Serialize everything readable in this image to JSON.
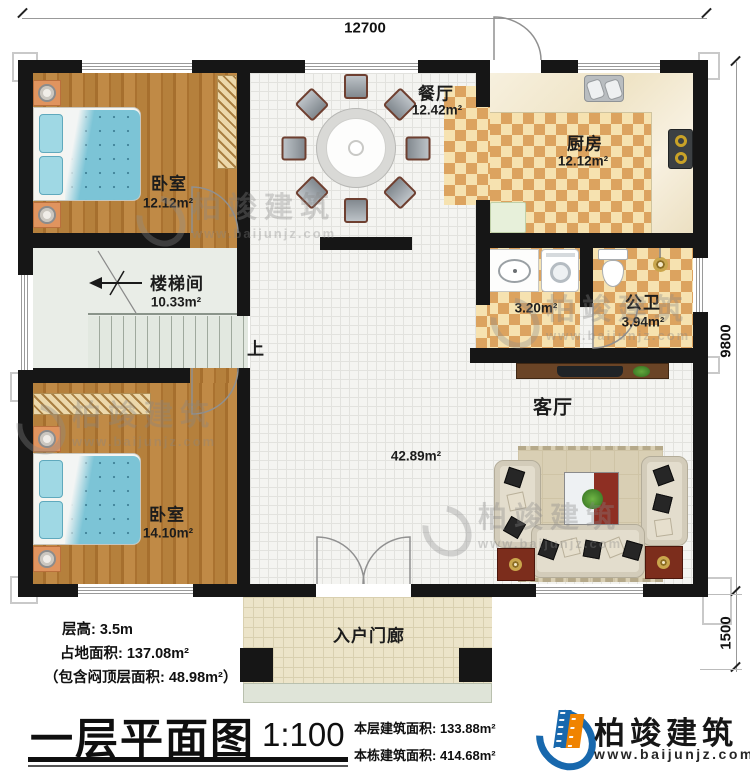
{
  "dimensions": {
    "top": "12700",
    "right_main": "9800",
    "right_porch": "1500"
  },
  "rooms": {
    "bedroom1": {
      "name": "卧室",
      "area": "12.12m²"
    },
    "dining": {
      "name": "餐厅",
      "area": "12.42m²"
    },
    "kitchen": {
      "name": "厨房",
      "area": "12.12m²"
    },
    "stairwell": {
      "name": "楼梯间",
      "area": "10.33m²"
    },
    "wash": {
      "area": "3.20m²"
    },
    "toilet": {
      "name": "公卫",
      "area": "3.94m²"
    },
    "living": {
      "name": "客厅",
      "area": "42.89m²"
    },
    "bedroom2": {
      "name": "卧室",
      "area": "14.10m²"
    },
    "porch": {
      "name": "入户门廊"
    }
  },
  "annotations": {
    "stairs_up": "上"
  },
  "info": {
    "floor_height": "层高: 3.5m",
    "land_area": "占地面积: 137.08m²",
    "attic_note": "（包含闷顶层面积: 48.98m²）"
  },
  "title_block": {
    "title": "一层平面图",
    "scale": "1:100",
    "floor_area": "本层建筑面积: 133.88m²",
    "building_area": "本栋建筑面积: 414.68m²"
  },
  "brand": {
    "name": "柏竣建筑",
    "url": "www.baijunjz.com"
  },
  "watermark": {
    "name": "柏竣建筑",
    "url": "www.baijunjz.com"
  },
  "colors": {
    "wall": "#161616",
    "checker_dark": "#dca35f",
    "checker_light": "#f6e2b0",
    "brand_blue": "#1868ad",
    "brand_orange": "#f08300"
  }
}
